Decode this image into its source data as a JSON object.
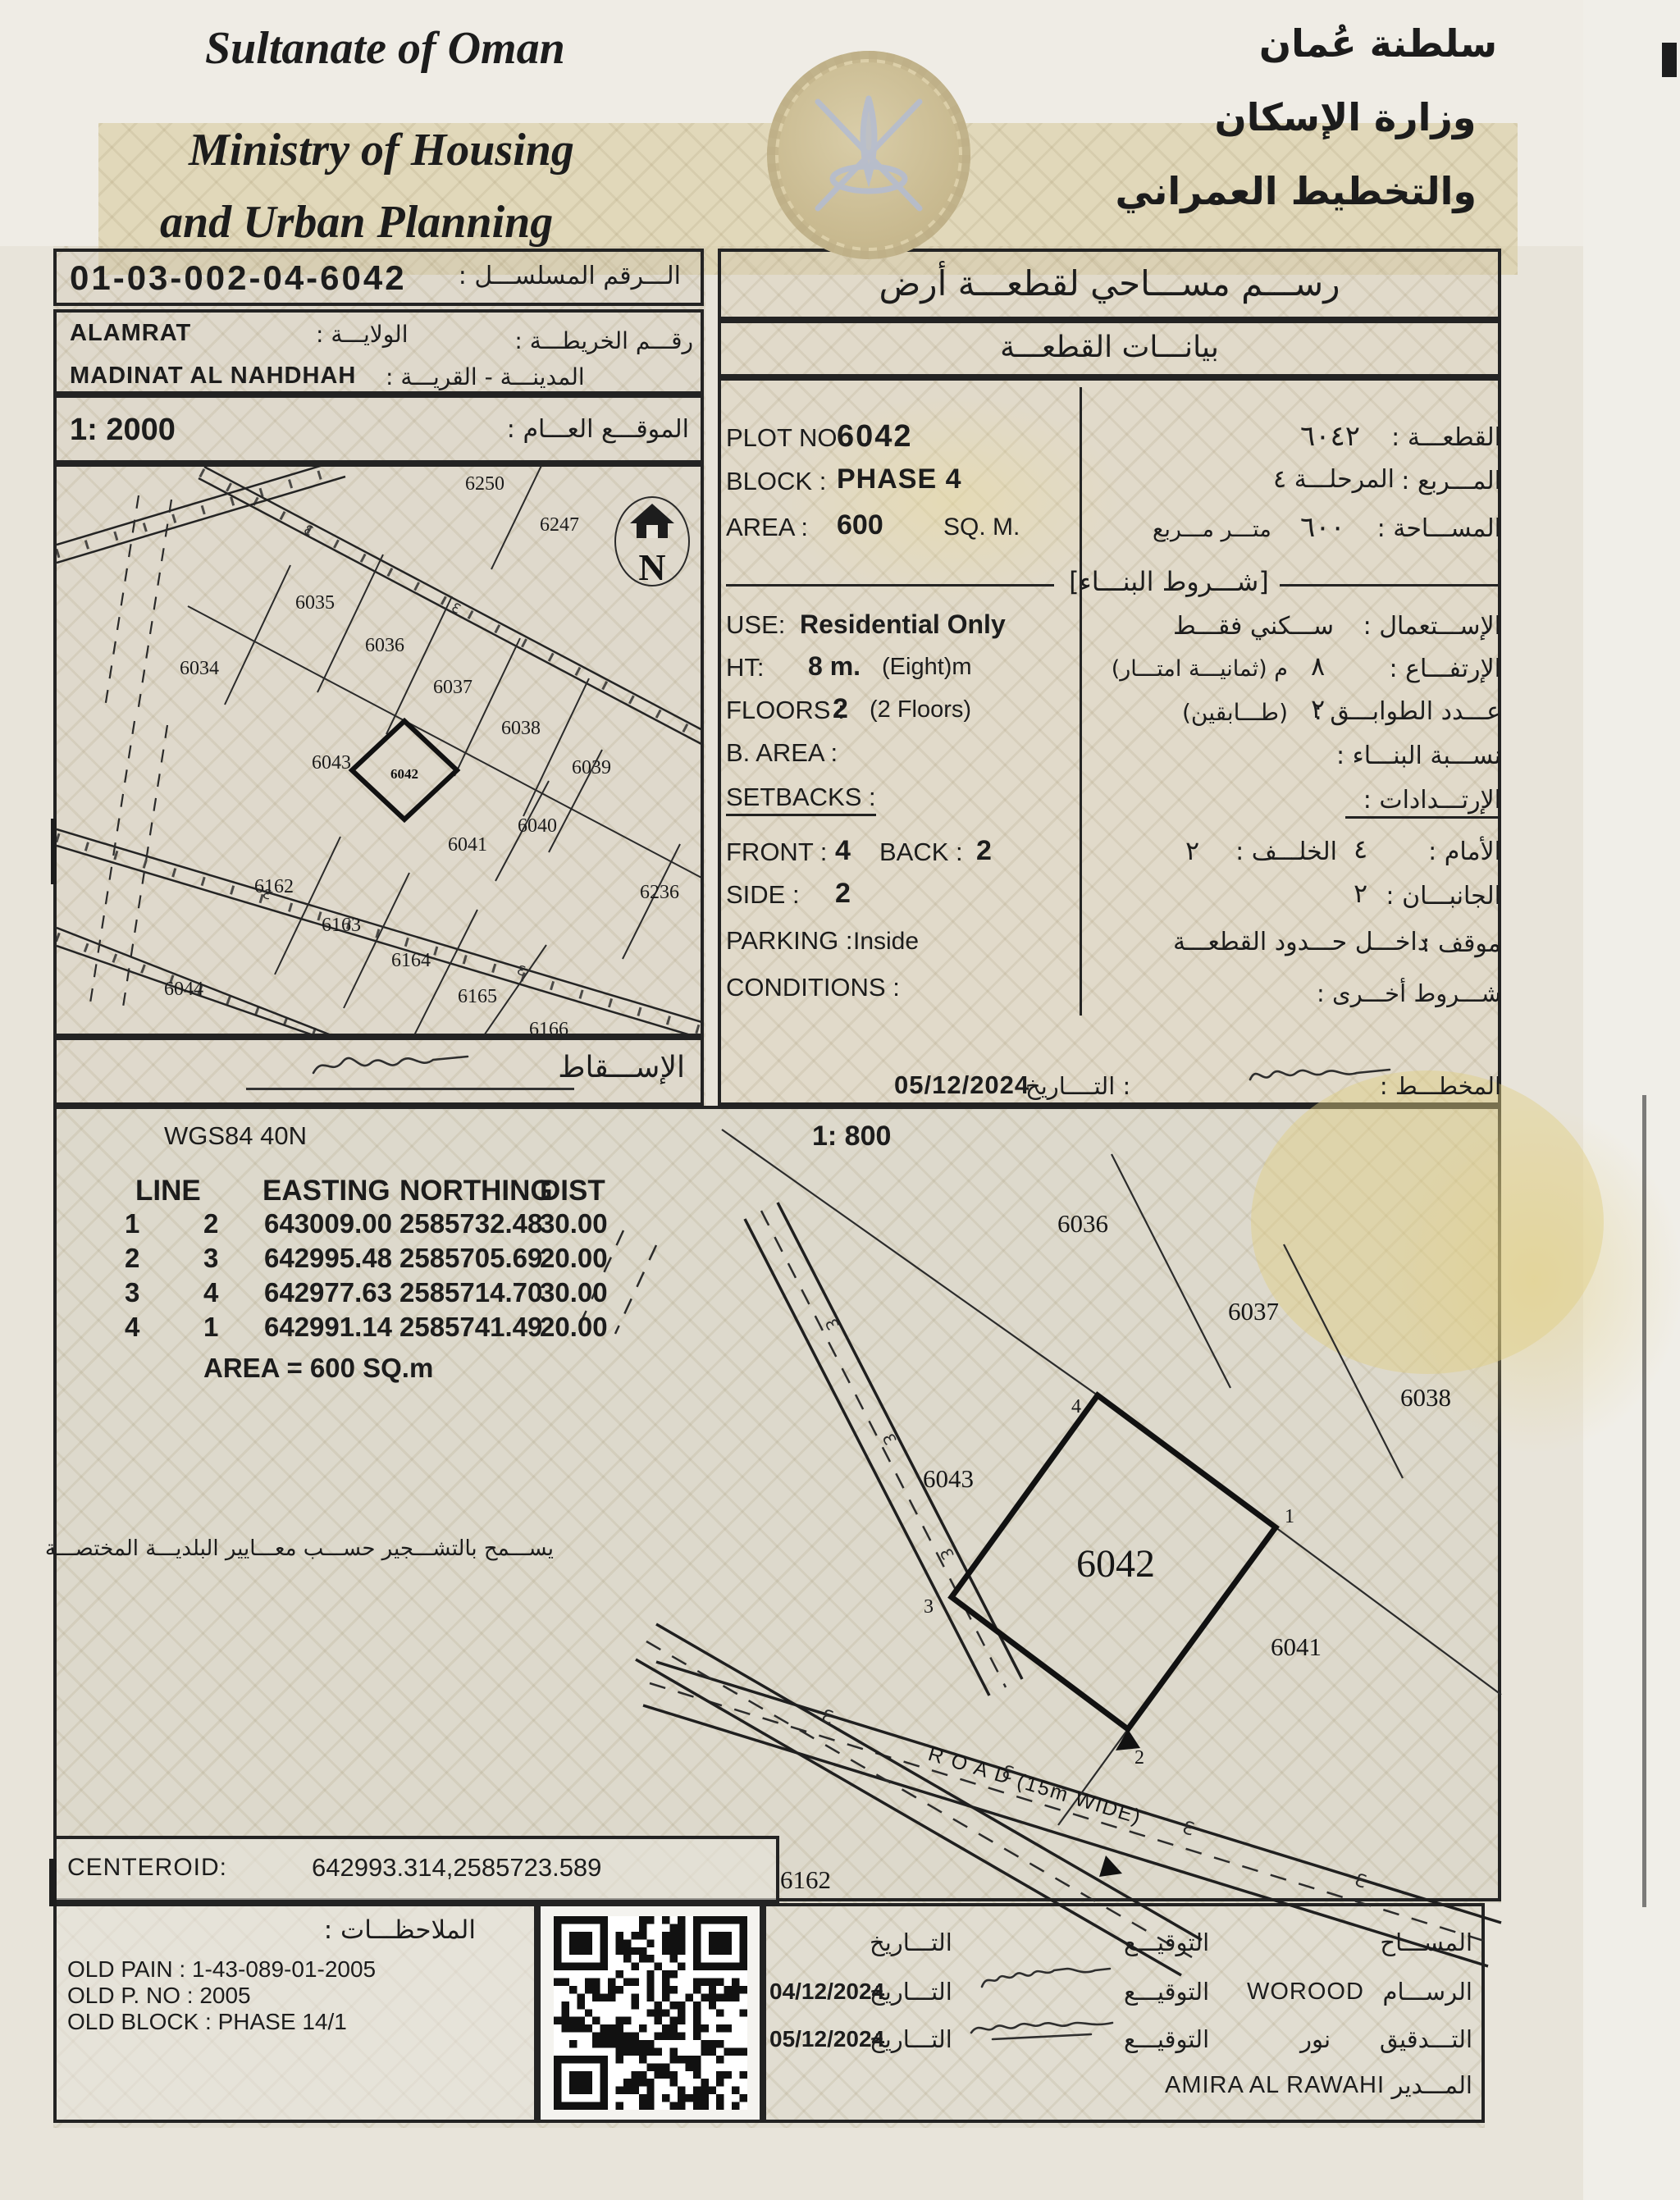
{
  "header": {
    "en_lines": [
      "Sultanate of Oman",
      "Ministry of Housing",
      "and Urban Planning"
    ],
    "ar_lines": [
      "سلطنة عُمان",
      "وزارة الإسكان",
      "والتخطيط العمراني"
    ]
  },
  "serial": {
    "label_ar": "الـــرقم المسلســـل :",
    "value": "01-03-002-04-6042"
  },
  "location": {
    "wilaya_label_ar": "الولايـــة :",
    "wilaya": "ALAMRAT",
    "map_no_label_ar": "رقـــم الخريطـــة :",
    "city_label_ar": "المدينـــة - القريـــة :",
    "city": "MADINAT AL NAHDHAH"
  },
  "site_map": {
    "scale": "1: 2000",
    "scale_label_ar": "الموقـــع العـــام :",
    "north_label": "N",
    "footer_label_ar": "الإســـقاط",
    "plots": [
      "6250",
      "6247",
      "6035",
      "6036",
      "6034",
      "6037",
      "6038",
      "6043",
      "6039",
      "6042",
      "6041",
      "6040",
      "6162",
      "6236",
      "6163",
      "6164",
      "6044",
      "6165",
      "6166"
    ]
  },
  "survey_panel": {
    "title_ar": "رســـم مســـاحي لقطعـــة أرض",
    "subtitle_ar": "بيانـــات القطعـــة",
    "plot_no": {
      "en_label": "PLOT NO :",
      "value": "6042",
      "ar_value": "٦٠٤٢",
      "ar_label": "القطعـــة :"
    },
    "block": {
      "en_label": "BLOCK :",
      "value": "PHASE 4",
      "ar_value": "المرحلـــة ٤",
      "ar_label": "المـــربع :"
    },
    "area": {
      "en_label": "AREA :",
      "value": "600",
      "en_unit": "SQ. M.",
      "ar_unit": "متـــر مـــربع",
      "ar_value": "٦٠٠",
      "ar_label": "المســـاحة :"
    },
    "building_terms_ar": "[شـــروط البنـــاء]",
    "use": {
      "en_label": "USE:",
      "value": "Residential Only",
      "ar_value": "ســـكني فقـــط",
      "ar_label": "الإســـتعمال :"
    },
    "height": {
      "en_label": "HT:",
      "value": "8 m.",
      "extra": "(Eight)m",
      "ar_value": "٨",
      "ar_extra": "م (ثمانيـــة امتـــار)",
      "ar_label": "الإرتفـــاع :"
    },
    "floors": {
      "en_label": "FLOORS :",
      "value": "2",
      "extra": "(2 Floors)",
      "ar_value": "٢",
      "ar_extra": "(طـــابقين)",
      "ar_label": "عـــدد الطوابـــق :"
    },
    "b_area": {
      "en_label": "B. AREA :",
      "ar_label": "نســـبة البنـــاء :"
    },
    "setbacks": {
      "en_label": "SETBACKS :",
      "ar_label": "الإرتـــدادات :"
    },
    "front": {
      "en_label": "FRONT :",
      "value": "4",
      "back_label": "BACK :",
      "back_value": "2",
      "ar_front_label": "الأمام :",
      "ar_front_value": "٤",
      "ar_back_label": "الخلـــف :",
      "ar_back_value": "٢"
    },
    "side": {
      "en_label": "SIDE :",
      "value": "2",
      "ar_label": "الجانبـــان :",
      "ar_value": "٢"
    },
    "parking": {
      "en_label": "PARKING :",
      "value": "Inside",
      "ar_value": "داخـــل حـــدود القطعـــة",
      "ar_label": "موقف :"
    },
    "conditions": {
      "en_label": "CONDITIONS :",
      "ar_label": "شـــروط أخـــرى :"
    },
    "date_row": {
      "date": "05/12/2024",
      "date_label_ar": ": التــــاريخ",
      "planner_label_ar": "المخطـــط :"
    }
  },
  "coords_section": {
    "datum": "WGS84 40N",
    "scale": "1: 800",
    "table": {
      "headers": [
        "LINE",
        "EASTING",
        "NORTHING",
        "DIST"
      ],
      "rows": [
        [
          "1",
          "2",
          "643009.00",
          "2585732.48",
          "30.00"
        ],
        [
          "2",
          "3",
          "642995.48",
          "2585705.69",
          "20.00"
        ],
        [
          "3",
          "4",
          "642977.63",
          "2585714.70",
          "30.00"
        ],
        [
          "4",
          "1",
          "642991.14",
          "2585741.49",
          "20.00"
        ]
      ]
    },
    "area_note": "AREA = 600  SQ.m",
    "tree_note_ar": "يســـمح بالتشـــجير حســـب معـــايير البلديـــة المختصـــة",
    "centeroid_label": "CENTEROID:",
    "centeroid_value": "642993.314,2585723.589"
  },
  "detail_map": {
    "plots": [
      "6036",
      "6037",
      "6038",
      "6043",
      "6042",
      "6041",
      "6162"
    ],
    "road_label": "R O A D (15m WIDE)",
    "vertices": [
      "1",
      "2",
      "3",
      "4"
    ],
    "tick": "Ɛ"
  },
  "notes": {
    "label_ar": "الملاحظـــات :",
    "lines": [
      "OLD PAIN : 1-43-089-01-2005",
      "OLD P. NO : 2005",
      "OLD BLOCK : PHASE 14/1"
    ]
  },
  "signatures": {
    "surveyor_ar": "المســـاح",
    "sign_ar": "التوقيـــع",
    "date_ar": "التـــاريخ",
    "draftsman_ar": "الرســـام",
    "draftsman_name": "WOROOD",
    "draftsman_date": "04/12/2024",
    "audit_ar": "التـــدقيق",
    "audit_name": "نور",
    "audit_date": "05/12/2024",
    "manager_ar": "المـــدير",
    "manager_name": "AMIRA AL RAWAHI"
  }
}
